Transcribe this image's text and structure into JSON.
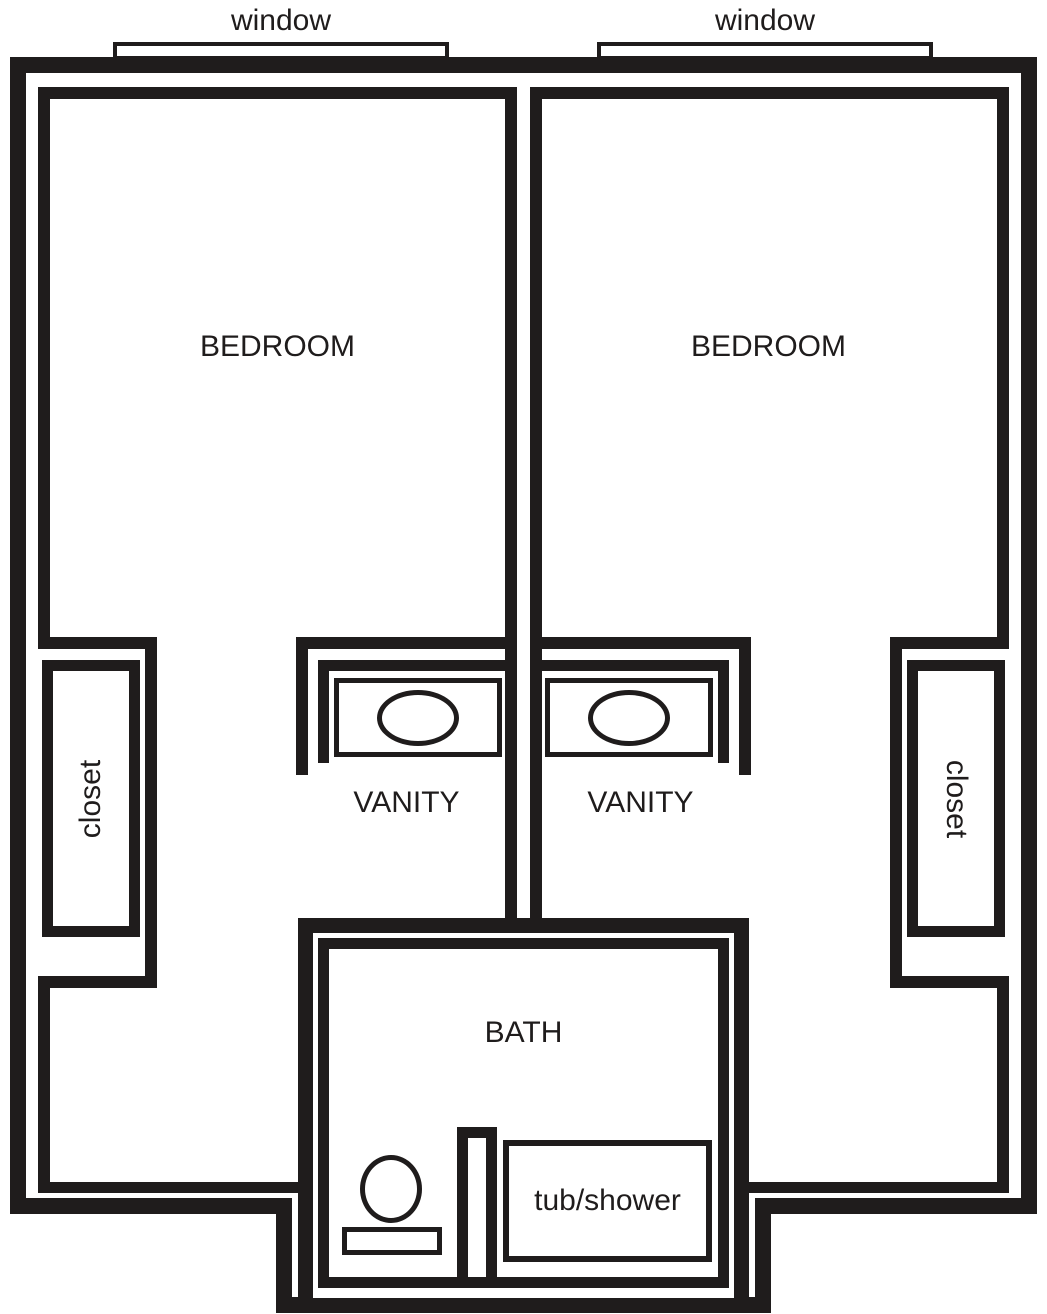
{
  "colors": {
    "ink": "#1f1c1c",
    "background": "#ffffff"
  },
  "plan": {
    "windows": [
      {
        "label": "window"
      },
      {
        "label": "window"
      }
    ],
    "bedrooms": [
      {
        "label": "BEDROOM"
      },
      {
        "label": "BEDROOM"
      }
    ],
    "closets": [
      {
        "label": "closet"
      },
      {
        "label": "closet"
      }
    ],
    "vanities": [
      {
        "label": "VANITY"
      },
      {
        "label": "VANITY"
      }
    ],
    "bath": {
      "label": "BATH",
      "tub_label": "tub/shower"
    }
  }
}
